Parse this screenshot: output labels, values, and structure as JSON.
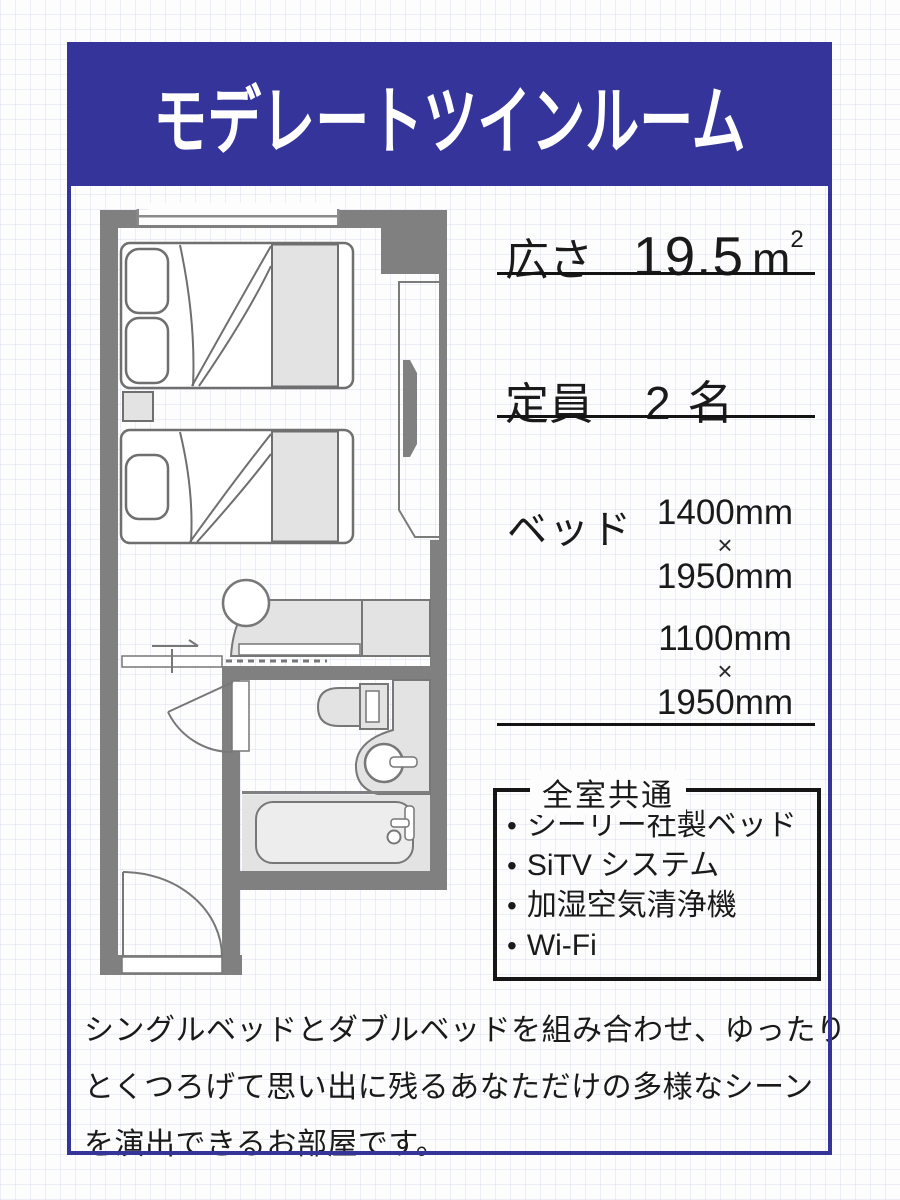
{
  "header": {
    "title": "モデレートツインルーム"
  },
  "specs": {
    "area": {
      "label": "広さ",
      "value": "19.5",
      "unit": "m",
      "unit_exp": "2"
    },
    "capacity": {
      "label": "定員",
      "value": "2 名"
    },
    "bed": {
      "label": "ベッド",
      "sizes": [
        {
          "width": "1400mm",
          "times": "×",
          "length": "1950mm"
        },
        {
          "width": "1100mm",
          "times": "×",
          "length": "1950mm"
        }
      ]
    }
  },
  "amenities": {
    "title": "全室共通",
    "bullet": "•",
    "items": [
      "シーリー社製ベッド",
      "SiTV システム",
      "加湿空気清浄機",
      "Wi-Fi"
    ]
  },
  "description": {
    "lines": [
      "シングルベッドとダブルベッドを組み合わせ、ゆったり",
      "とくつろげて思い出に残るあなただけの多様なシーン",
      "を演出できるお部屋です。"
    ]
  },
  "colors": {
    "accent_blue": "#34349B",
    "wall_gray": "#808080",
    "fixture_gray": "#e3e3e3",
    "text_black": "#1a1a1a"
  },
  "floorplan": {
    "features": [
      "window",
      "double-bed",
      "single-bed",
      "nightstand",
      "closet",
      "desk",
      "chair",
      "sliding-door",
      "bathroom-door",
      "toilet",
      "sink",
      "bathtub",
      "entrance-door"
    ]
  }
}
